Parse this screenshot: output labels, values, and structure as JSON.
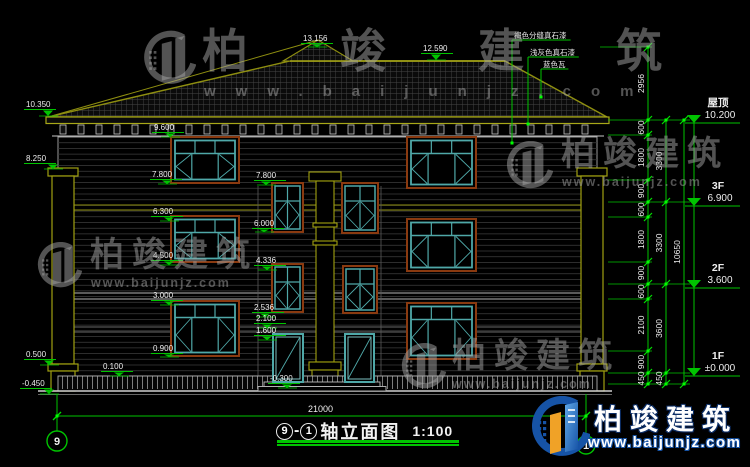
{
  "watermark": {
    "brand": "柏竣建筑",
    "url": "www.baijunjz.com"
  },
  "corner_logo": {
    "brand": "柏竣建筑",
    "url": "www.baijunjz.com"
  },
  "title_block": {
    "axis_from": "9",
    "dash": "-",
    "axis_to": "1",
    "title": "轴立面图",
    "scale": "1:100"
  },
  "bottom_dimension": {
    "value": "21000",
    "x1": 57,
    "x2": 586,
    "y": 416,
    "label_x": 308,
    "label_y": 412
  },
  "axis_bubbles": [
    {
      "label": "9",
      "cx": 57,
      "cy": 441,
      "r": 10
    },
    {
      "label": "1",
      "cx": 586,
      "cy": 445,
      "r": 9
    }
  ],
  "materials": [
    {
      "label": "褐色分缝真石漆",
      "tx": 512,
      "ty": 40,
      "ex": 512,
      "ey": 143
    },
    {
      "label": "浅灰色真石漆",
      "tx": 528,
      "ty": 57,
      "ex": 528,
      "ey": 124
    },
    {
      "label": "蓝色瓦",
      "tx": 541,
      "ty": 69,
      "ex": 541,
      "ey": 97
    }
  ],
  "elevation_markers": [
    {
      "v": "13.156",
      "tx": 303,
      "ty": 41,
      "px": 317,
      "py": 47
    },
    {
      "v": "12.590",
      "tx": 423,
      "ty": 51,
      "px": 436,
      "py": 60
    },
    {
      "v": "10.350",
      "tx": 26,
      "ty": 107,
      "px": 48,
      "py": 116
    },
    {
      "v": "9.600",
      "tx": 154,
      "ty": 130,
      "px": 170,
      "py": 137
    },
    {
      "v": "8.250",
      "tx": 26,
      "ty": 161,
      "px": 53,
      "py": 169
    },
    {
      "v": "7.800",
      "tx": 152,
      "ty": 177,
      "px": 167,
      "py": 184
    },
    {
      "v": "7.800",
      "tx": 256,
      "ty": 178,
      "px": 266,
      "py": 185
    },
    {
      "v": "6.300",
      "tx": 153,
      "ty": 214,
      "px": 169,
      "py": 221
    },
    {
      "v": "6.000",
      "tx": 254,
      "ty": 226,
      "px": 264,
      "py": 232
    },
    {
      "v": "4.500",
      "tx": 153,
      "ty": 258,
      "px": 169,
      "py": 265
    },
    {
      "v": "4.336",
      "tx": 256,
      "ty": 263,
      "px": 267,
      "py": 270
    },
    {
      "v": "3.000",
      "tx": 153,
      "ty": 298,
      "px": 169,
      "py": 305
    },
    {
      "v": "2.536",
      "tx": 254,
      "ty": 310,
      "px": 265,
      "py": 317
    },
    {
      "v": "2.100",
      "tx": 256,
      "ty": 321,
      "px": 267,
      "py": 328
    },
    {
      "v": "1.600",
      "tx": 256,
      "ty": 333,
      "px": 267,
      "py": 340
    },
    {
      "v": "0.900",
      "tx": 153,
      "ty": 351,
      "px": 169,
      "py": 357
    },
    {
      "v": "0.100",
      "tx": 103,
      "ty": 369,
      "px": 119,
      "py": 376
    },
    {
      "v": "-0.300",
      "tx": 270,
      "ty": 381,
      "px": 287,
      "py": 388
    },
    {
      "v": "0.500",
      "tx": 26,
      "ty": 357,
      "px": 49,
      "py": 365
    },
    {
      "v": "-0.450",
      "tx": 22,
      "ty": 386,
      "px": 49,
      "py": 394
    }
  ],
  "level_flags": [
    {
      "floor": "屋顶",
      "value": "10.200",
      "y": 123
    },
    {
      "floor": "3F",
      "value": "6.900",
      "y": 206
    },
    {
      "floor": "2F",
      "value": "3.600",
      "y": 288
    },
    {
      "floor": "1F",
      "value": "±0.000",
      "y": 376
    }
  ],
  "dim_chains": [
    {
      "x": 648,
      "segments": [
        [
          "2956",
          47,
          120
        ],
        [
          "600",
          120,
          135
        ],
        [
          "1800",
          135,
          180
        ],
        [
          "900",
          180,
          202
        ],
        [
          "600",
          202,
          217
        ],
        [
          "1800",
          217,
          262
        ],
        [
          "900",
          262,
          284
        ],
        [
          "600",
          284,
          299
        ],
        [
          "2100",
          299,
          351
        ],
        [
          "900",
          351,
          373
        ],
        [
          "450",
          373,
          384
        ]
      ]
    },
    {
      "x": 666,
      "segments": [
        [
          "3300",
          120,
          202
        ],
        [
          "3300",
          202,
          284
        ],
        [
          "3600",
          284,
          373
        ],
        [
          "450",
          373,
          384
        ]
      ]
    },
    {
      "x": 684,
      "segments": [
        [
          "10650",
          120,
          384
        ]
      ]
    }
  ],
  "tie_lines": [
    [
      47,
      600,
      652
    ],
    [
      120,
      608,
      690
    ],
    [
      135,
      608,
      652
    ],
    [
      180,
      608,
      652
    ],
    [
      202,
      608,
      690
    ],
    [
      217,
      608,
      652
    ],
    [
      262,
      608,
      652
    ],
    [
      284,
      608,
      690
    ],
    [
      299,
      608,
      652
    ],
    [
      351,
      608,
      652
    ],
    [
      373,
      608,
      690
    ],
    [
      384,
      608,
      690
    ]
  ],
  "windows": [
    {
      "type": "large",
      "x": 171,
      "y": 137,
      "w": 68,
      "h": 46
    },
    {
      "type": "large",
      "x": 407,
      "y": 137,
      "w": 69,
      "h": 51
    },
    {
      "type": "large",
      "x": 171,
      "y": 216,
      "w": 68,
      "h": 46
    },
    {
      "type": "large",
      "x": 407,
      "y": 219,
      "w": 69,
      "h": 52
    },
    {
      "type": "large",
      "x": 171,
      "y": 301,
      "w": 68,
      "h": 55
    },
    {
      "type": "large",
      "x": 407,
      "y": 303,
      "w": 69,
      "h": 56
    },
    {
      "type": "narrow",
      "x": 272,
      "y": 183,
      "w": 31,
      "h": 49
    },
    {
      "type": "narrow",
      "x": 342,
      "y": 183,
      "w": 36,
      "h": 50
    },
    {
      "type": "narrow",
      "x": 272,
      "y": 264,
      "w": 31,
      "h": 48
    },
    {
      "type": "narrow",
      "x": 343,
      "y": 266,
      "w": 34,
      "h": 47
    }
  ],
  "doors": [
    {
      "x": 273,
      "y": 334,
      "w": 30,
      "h": 48
    },
    {
      "x": 345,
      "y": 334,
      "w": 29,
      "h": 48
    }
  ],
  "colors": {
    "dim_green": "#00c400",
    "grip_green": "#00ff00",
    "olive": "#9a9a12",
    "teal": "#4fa8a8",
    "brown": "#8a3a10",
    "text": "#ededed"
  }
}
